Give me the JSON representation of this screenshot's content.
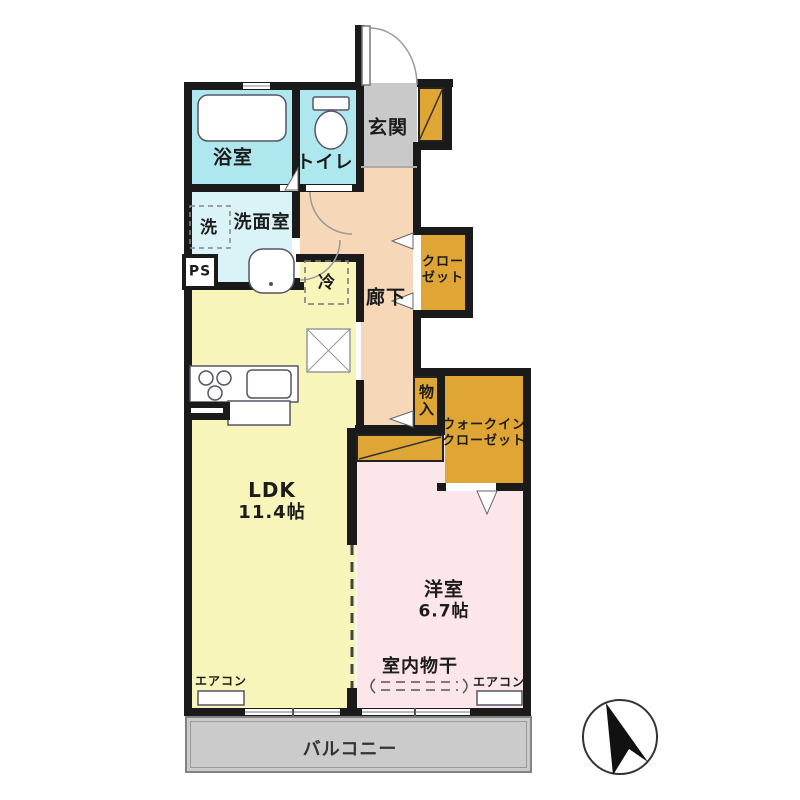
{
  "rooms": {
    "bath": {
      "label": "浴室"
    },
    "toilet": {
      "label": "トイレ"
    },
    "entrance": {
      "label": "玄関"
    },
    "washer": {
      "label": "洗"
    },
    "washroom": {
      "label": "洗面室"
    },
    "pipe_space": {
      "label": "PS"
    },
    "fridge": {
      "label": "冷"
    },
    "corridor": {
      "label": "廊下"
    },
    "closet": {
      "line1": "クロー",
      "line2": "ゼット"
    },
    "storage": {
      "label": "物入"
    },
    "walk_in_closet": {
      "line1": "ウォークイン",
      "line2": "クローゼット"
    },
    "ldk": {
      "label": "LDK",
      "size": "11.4帖"
    },
    "bedroom": {
      "label": "洋室",
      "size": "6.7帖"
    },
    "indoor_drying": {
      "label": "室内物干"
    },
    "aircon_left": {
      "label": "エアコン"
    },
    "aircon_right": {
      "label": "エアコン"
    },
    "balcony": {
      "label": "バルコニー"
    }
  },
  "colors": {
    "wall": "#1a1a1a",
    "bath_cyan": "#aee8ee",
    "washroom_cyan": "#daf3f6",
    "entrance_gray": "#c9c9c9",
    "corridor_peach": "#f6d7b7",
    "ldk_yellow": "#f8f5bb",
    "bedroom_pink": "#fce6e9",
    "closet_gold": "#dfa535",
    "balcony_gray": "#cbcbcb"
  }
}
